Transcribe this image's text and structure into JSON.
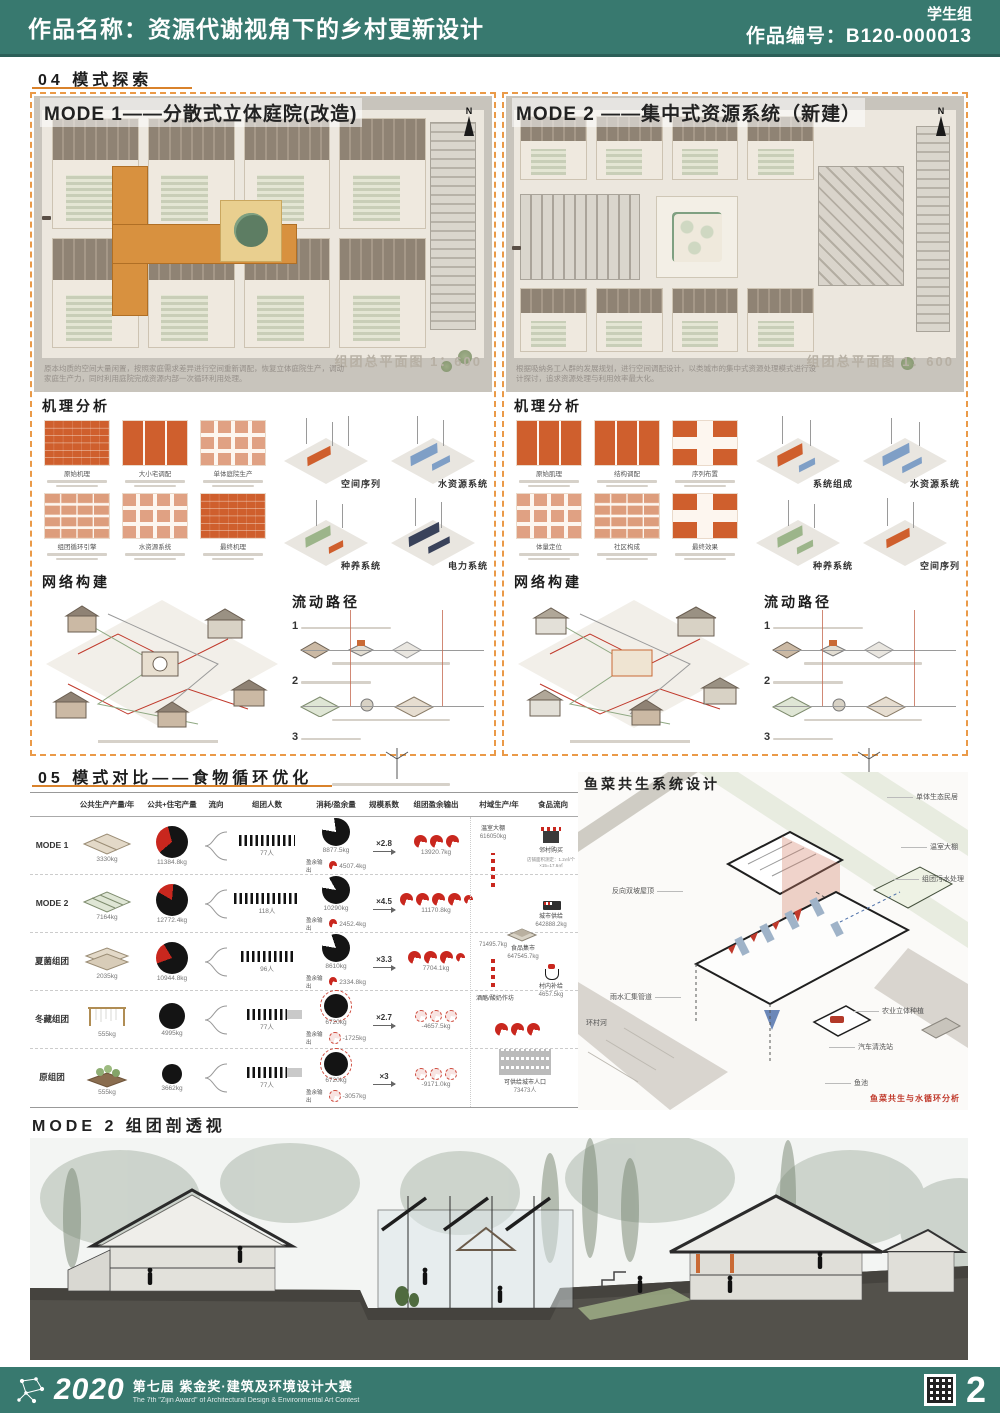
{
  "header": {
    "title": "作品名称：资源代谢视角下的乡村更新设计",
    "group": "学生组",
    "code": "作品编号：B120-000013"
  },
  "section04": {
    "heading": "04 模式探索",
    "north": "N",
    "mode1": {
      "title": "MODE 1——分散式立体庭院(改造)",
      "plan_caption": "组团总平面图 1：600",
      "desc": "原本均质的空间大量闲置，按照家庭需求差异进行空间重新调配，恢复立体庭院生产，调动家庭生产力，同时利用庭院完成资源内部一次循环利用处理。",
      "mech_heading": "机理分析",
      "mech_labels": [
        "原始机理",
        "大小宅调配",
        "单体庭院生产",
        "组团循环引擎",
        "水资源系统",
        "最终机理"
      ],
      "axon_labels": [
        "空间序列",
        "水资源系统",
        "种养系统",
        "电力系统"
      ],
      "network_heading": "网络构建",
      "flow_heading": "流动路径",
      "flow_steps": [
        "1",
        "2",
        "3"
      ]
    },
    "mode2": {
      "title": "MODE 2 ——集中式资源系统（新建）",
      "plan_caption": "组团总平面图 1：600",
      "desc": "根据吸纳务工人群的发展规划，进行空间调配设计，以类城市的集中式资源处理模式进行设计探讨，追求资源处理与利用效率最大化。",
      "mech_heading": "机理分析",
      "mech_labels": [
        "原始肌理",
        "结构调配",
        "序列布置",
        "体量定位",
        "社区构成",
        "最终效果"
      ],
      "axon_labels": [
        "系统组成",
        "水资源系统",
        "种养系统",
        "空间序列"
      ],
      "network_heading": "网络构建",
      "flow_heading": "流动路径",
      "flow_steps": [
        "1",
        "2",
        "3"
      ]
    }
  },
  "section05": {
    "heading": "05 模式对比——食物循环优化",
    "table": {
      "columns": [
        "公共生产产量/年",
        "公共+住宅产量",
        "流向",
        "组团人数",
        "消耗/盈余量",
        "规模系数",
        "组团盈余输出",
        "村域生产/年",
        "食品流向"
      ],
      "surplus_label": "盈余输出",
      "rows": [
        {
          "label": "MODE 1",
          "produce": "3330kg",
          "total": "11384.8kg",
          "people": "77人",
          "consume": "8877.5kg",
          "surplus": "4507.4kg",
          "coef": "×2.8",
          "output": "13920.7kg"
        },
        {
          "label": "MODE 2",
          "produce": "7164kg",
          "total": "12772.4kg",
          "people": "118人",
          "consume": "10290kg",
          "surplus": "2452.4kg",
          "coef": "×4.5",
          "output": "11170.8kg"
        },
        {
          "label": "夏菌组团",
          "produce": "2035kg",
          "total": "10944.8kg",
          "people": "96人",
          "consume": "8610kg",
          "surplus": "2334.8kg",
          "coef": "×3.3",
          "output": "7704.1kg"
        },
        {
          "label": "冬藏组团",
          "produce": "555kg",
          "total": "4995kg",
          "people": "77人",
          "consume": "6720kg",
          "surplus": "-1725kg",
          "coef": "×2.7",
          "output": "-4657.5kg"
        },
        {
          "label": "原组团",
          "produce": "555kg",
          "total": "3662kg",
          "people": "77人",
          "consume": "6720kg",
          "surplus": "-3057kg",
          "coef": "×3",
          "output": "-9171.0kg"
        }
      ],
      "flow": {
        "greenhouse": "温室大棚",
        "greenhouse_val": "616050kg",
        "junction_val": "71495.7kg",
        "workshop": "酒酪/酸奶作坊",
        "market": "食品集市",
        "market_val": "647545.7kg",
        "neighbor": "邻村购买",
        "neighbor_note": "店铺面积测定：1.2㎡/个×15=17.6㎡",
        "city": "城市供给",
        "city_val": "642888.2kg",
        "village": "村内补给",
        "village_val": "4657.5kg",
        "population": "可供给城市人口",
        "population_val": "73473人"
      }
    },
    "fish": {
      "heading": "鱼菜共生系统设计",
      "labels": [
        "单体生态民居",
        "温室大棚",
        "组团污水处理",
        "反向双坡屋顶",
        "雨水汇集管道",
        "环村河",
        "农业立体种植",
        "汽车清洗站",
        "鱼池"
      ],
      "caption": "鱼菜共生与水循环分析"
    }
  },
  "section_perspective": {
    "heading": "MODE 2 组团剖透视"
  },
  "footer": {
    "year": "2020",
    "title_cn": "第七届 紫金奖·建筑及环境设计大赛",
    "title_en": "The 7th \"Zijin Award\" of Architectural Design & Environmental Art Contest",
    "page": "2"
  },
  "colors": {
    "teal": "#38796f",
    "orange": "#ea9a48",
    "red": "#c9271e"
  }
}
